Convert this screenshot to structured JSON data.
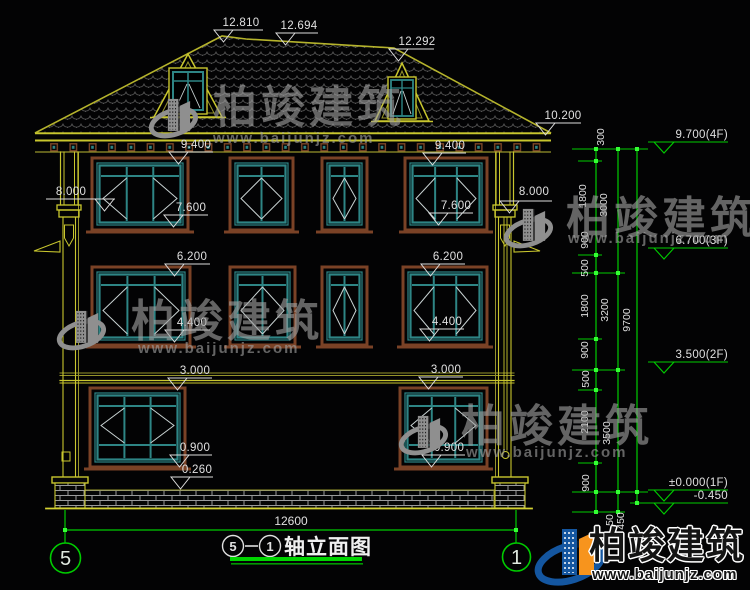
{
  "drawing_title": {
    "axis_a": "5",
    "separator": "—",
    "axis_b": "1",
    "text": "轴立面图"
  },
  "axes": {
    "left": "5",
    "right": "1"
  },
  "overall_width_dim": "12600",
  "colors": {
    "background": "#030304",
    "outline_yellow": "#c8c62e",
    "outline_olive": "#96942a",
    "window_frame_brown": "#7a4226",
    "window_teal": "#2e8585",
    "dimension_green": "#00cc00",
    "text_white": "#e0e0e0",
    "brand_blue": "#1456a0",
    "brand_orange": "#f7941d"
  },
  "elevation_labels": [
    {
      "text": "12.810",
      "cx": 241,
      "by": 26,
      "ux1": 214,
      "ux2": 263,
      "uy": 30,
      "tx": 214
    },
    {
      "text": "12.694",
      "cx": 299,
      "by": 29,
      "ux1": 276,
      "ux2": 318,
      "uy": 33,
      "tx": 276
    },
    {
      "text": "12.292",
      "cx": 417,
      "by": 45,
      "ux1": 389,
      "ux2": 434,
      "uy": 49,
      "tx": 389
    },
    {
      "text": "10.200",
      "cx": 563,
      "by": 119,
      "ux1": 536,
      "ux2": 581,
      "uy": 123,
      "tx": 536
    },
    {
      "text": "9.400",
      "cx": 196,
      "by": 148,
      "ux1": 169,
      "ux2": 213,
      "uy": 152,
      "tx": 169
    },
    {
      "text": "9.400",
      "cx": 450,
      "by": 149,
      "ux1": 423,
      "ux2": 466,
      "uy": 153,
      "tx": 423
    },
    {
      "text": "8.000",
      "cx": 71,
      "by": 195,
      "ux1": 46,
      "ux2": 115,
      "uy": 199,
      "tx": 95
    },
    {
      "text": "8.000",
      "cx": 534,
      "by": 195,
      "ux1": 500,
      "ux2": 552,
      "uy": 201,
      "tx": 500
    },
    {
      "text": "7.600",
      "cx": 191,
      "by": 211,
      "ux1": 164,
      "ux2": 208,
      "uy": 215,
      "tx": 164
    },
    {
      "text": "7.600",
      "cx": 456,
      "by": 209,
      "ux1": 429,
      "ux2": 473,
      "uy": 213,
      "tx": 429
    },
    {
      "text": "6.200",
      "cx": 192,
      "by": 260,
      "ux1": 165,
      "ux2": 210,
      "uy": 264,
      "tx": 165
    },
    {
      "text": "6.200",
      "cx": 448,
      "by": 260,
      "ux1": 421,
      "ux2": 465,
      "uy": 264,
      "tx": 421
    },
    {
      "text": "4.400",
      "cx": 192,
      "by": 326,
      "ux1": 165,
      "ux2": 210,
      "uy": 330,
      "tx": 165
    },
    {
      "text": "4.400",
      "cx": 447,
      "by": 325,
      "ux1": 420,
      "ux2": 464,
      "uy": 329,
      "tx": 420
    },
    {
      "text": "3.000",
      "cx": 195,
      "by": 374,
      "ux1": 168,
      "ux2": 212,
      "uy": 378,
      "tx": 168
    },
    {
      "text": "3.000",
      "cx": 446,
      "by": 373,
      "ux1": 419,
      "ux2": 463,
      "uy": 377,
      "tx": 419
    },
    {
      "text": "0.900",
      "cx": 195,
      "by": 451,
      "ux1": 170,
      "ux2": 212,
      "uy": 455,
      "tx": 170
    },
    {
      "text": "0.900",
      "cx": 449,
      "by": 451,
      "ux1": 422,
      "ux2": 465,
      "uy": 455,
      "tx": 422
    },
    {
      "text": "0.260",
      "cx": 197,
      "by": 473,
      "ux1": 171,
      "ux2": 213,
      "uy": 477,
      "tx": 171
    }
  ],
  "chain_texts": [
    {
      "text": "300",
      "x": 604,
      "y": 137
    },
    {
      "text": "1800",
      "x": 586,
      "y": 196
    },
    {
      "text": "3000",
      "x": 607,
      "y": 205
    },
    {
      "text": "900",
      "x": 588,
      "y": 240
    },
    {
      "text": "500",
      "x": 588,
      "y": 268
    },
    {
      "text": "1800",
      "x": 588,
      "y": 306
    },
    {
      "text": "3200",
      "x": 608,
      "y": 310
    },
    {
      "text": "9700",
      "x": 630,
      "y": 320
    },
    {
      "text": "900",
      "x": 588,
      "y": 350
    },
    {
      "text": "500",
      "x": 589,
      "y": 379
    },
    {
      "text": "2100",
      "x": 588,
      "y": 422
    },
    {
      "text": "3500",
      "x": 610,
      "y": 433
    },
    {
      "text": "900",
      "x": 589,
      "y": 483
    },
    {
      "text": "450",
      "x": 624,
      "y": 521
    },
    {
      "text": "50",
      "x": 613,
      "y": 520
    }
  ],
  "level_flags": [
    {
      "text": "9.700(4F)",
      "y": 142
    },
    {
      "text": "6.700(3F)",
      "y": 248
    },
    {
      "text": "3.500(2F)",
      "y": 362
    },
    {
      "text": "±0.000(1F)",
      "y": 490
    },
    {
      "text": "-0.450",
      "y": 503
    }
  ],
  "watermark": {
    "title": "柏竣建筑",
    "url": "www.baijunjz.com"
  },
  "logo": {
    "title": "柏竣建筑",
    "url": "www.baijunjz.com"
  }
}
